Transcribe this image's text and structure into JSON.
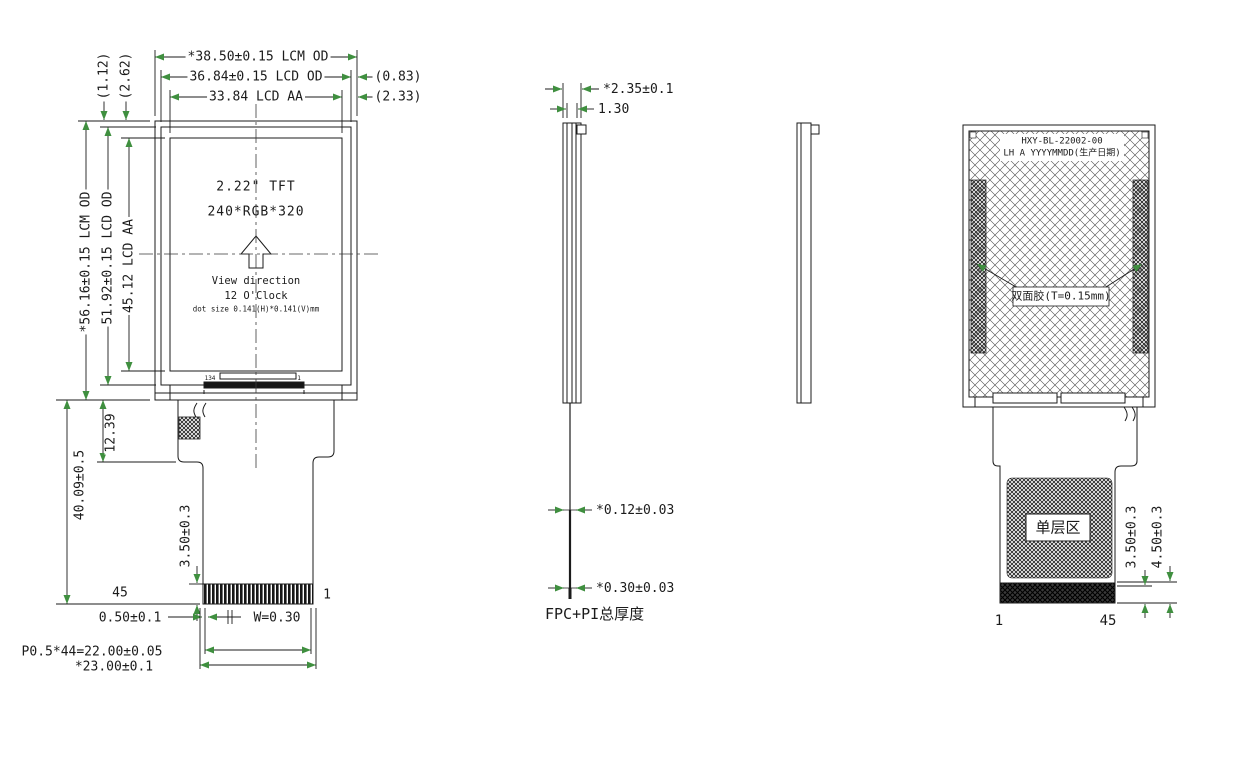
{
  "colors": {
    "line": "#1b1b1b",
    "arrow_head": "#3f8f3f",
    "background": "#ffffff"
  },
  "front_view": {
    "dim_lcm_width": "*38.50±0.15 LCM OD",
    "dim_lcd_width": "36.84±0.15 LCD OD",
    "dim_lcd_margin_h": "(0.83)",
    "dim_aa_width": "33.84 LCD AA",
    "dim_aa_margin_h": "(2.33)",
    "dim_lcm_height": "*56.16±0.15 LCM OD",
    "dim_lcd_height": "51.92±0.15 LCD OD",
    "dim_aa_height": "45.12 LCD AA",
    "dim_lcd_margin_v": "(1.12)",
    "dim_aa_margin_v": "(2.62)",
    "screen_size": "2.22\" TFT",
    "screen_res": "240*RGB*320",
    "view_direction_1": "View direction",
    "view_direction_2": "12 O'Clock",
    "dot_size": "dot size 0.141(H)*0.141(V)mm",
    "ic_pin_left": "134",
    "ic_pin_right": "1",
    "dim_shoulder": "12.39",
    "dim_fpc_length": "40.09±0.5",
    "dim_finger_len": "3.50±0.3",
    "pin_last": "45",
    "pin_first": "1",
    "dim_margin": "0.50±0.1",
    "dim_finger_w": "W=0.30",
    "dim_pitch": "P0.5*44=22.00±0.05",
    "dim_fpc_width": "*23.00±0.1"
  },
  "side_view": {
    "dim_total_thickness": "*2.35±0.1",
    "dim_panel_thickness": "1.30",
    "dim_fpc_thickness_1": "*0.12±0.03",
    "dim_fpc_thickness_2": "*0.30±0.03",
    "label_fpc": "FPC+PI总厚度"
  },
  "back_view": {
    "part_number": "HXY-BL-22002-00",
    "date_code": "LH A YYYYMMDD(生产日期)",
    "tape_label": "双面胶(T=0.15mm)",
    "single_layer_label": "单层区",
    "dim_strip": "3.50±0.3",
    "dim_strip_total": "4.50±0.3",
    "pin_first": "1",
    "pin_last": "45"
  }
}
